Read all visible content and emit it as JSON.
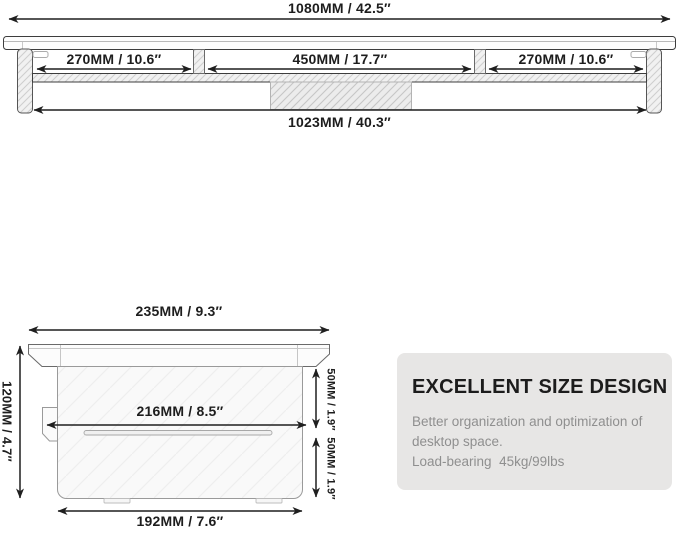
{
  "front_view": {
    "overall_width_label": "1080MM / 42.5″",
    "left_section_label": "270MM / 10.6″",
    "middle_section_label": "450MM / 17.7″",
    "right_section_label": "270MM / 10.6″",
    "inner_width_label": "1023MM / 40.3″"
  },
  "side_view": {
    "top_depth_label": "235MM / 9.3″",
    "height_label": "120MM / 4.7″",
    "shelf_depth_label": "216MM / 8.5″",
    "upper_gap_label": "50MM / 1.9″",
    "lower_gap_label": "50MM / 1.9″",
    "base_depth_label": "192MM / 7.6″"
  },
  "info_box": {
    "title": "EXCELLENT SIZE DESIGN",
    "description": "Better organization and optimization of desktop space.",
    "load_bearing": "Load-bearing  45kg/99lbs"
  },
  "colors": {
    "line": "#1f1f1f",
    "label_text": "#1d1d1d",
    "info_box_bg": "#e7e6e5",
    "info_body_text": "#8f8f8f",
    "hatch": "#cfcfcf"
  }
}
